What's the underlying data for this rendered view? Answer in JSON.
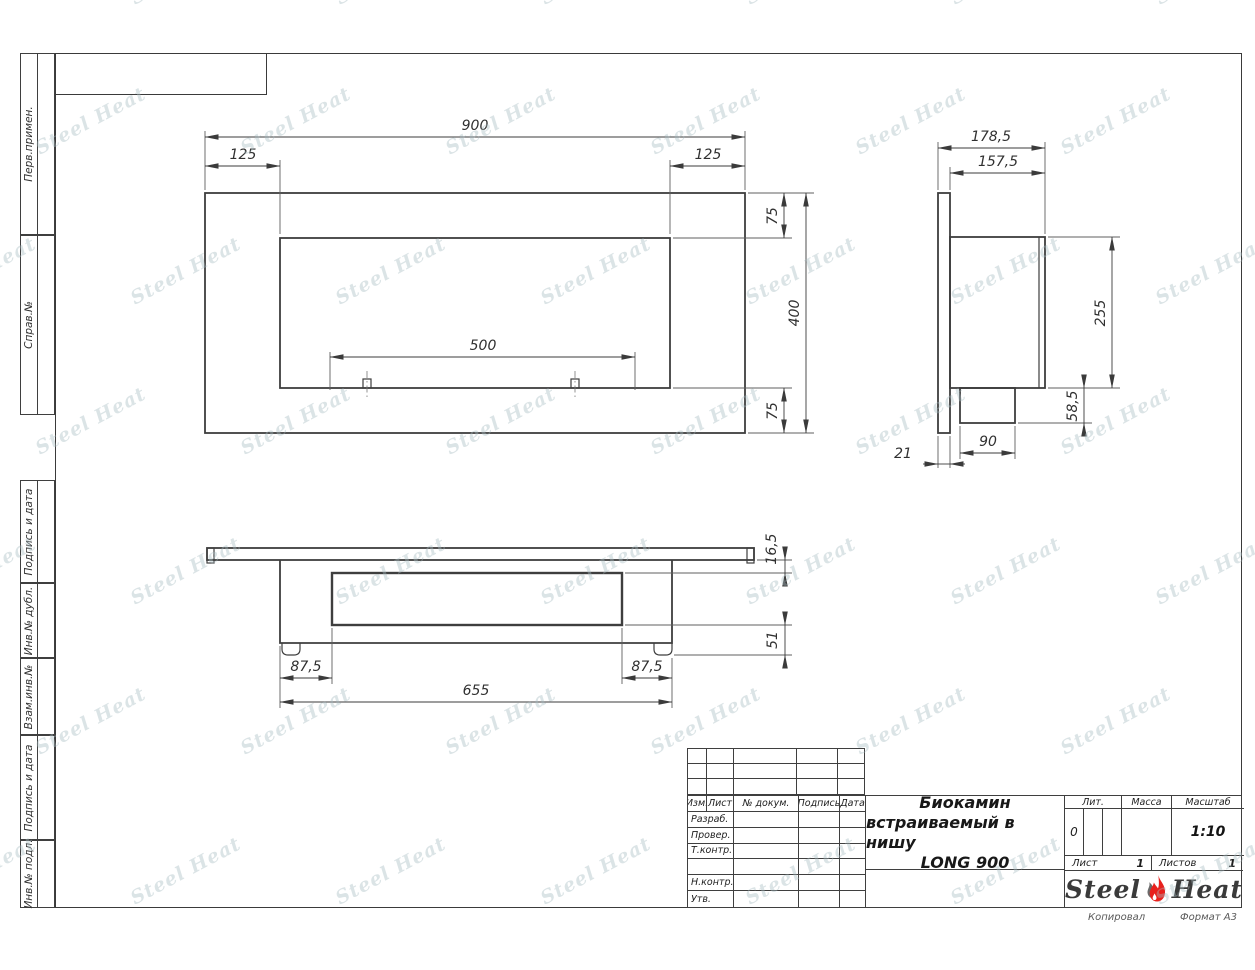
{
  "watermark": {
    "text": "Steel Heat"
  },
  "frame": {
    "left_labels": [
      {
        "label": "Перв.примен."
      },
      {
        "label": "Справ.№"
      },
      {
        "label": "Подпись и дата"
      },
      {
        "label": "Инв.№ дубл."
      },
      {
        "label": "Взам.инв.№"
      },
      {
        "label": "Подпись и дата"
      },
      {
        "label": "Инв.№ подл."
      }
    ]
  },
  "views": {
    "front": {
      "dims": {
        "width": "900",
        "left_offset": "125",
        "right_offset": "125",
        "top_offset": "75",
        "height": "400",
        "bottom_offset": "75",
        "burner": "500"
      }
    },
    "side": {
      "dims": {
        "depth_total": "178,5",
        "depth_body": "157,5",
        "body_height": "255",
        "ledge_height": "58,5",
        "ledge_depth": "90",
        "panel_thickness": "21"
      }
    },
    "bottom": {
      "dims": {
        "frame_depth": "16,5",
        "box_depth": "51",
        "side_left": "87,5",
        "side_right": "87,5",
        "body_width": "655"
      }
    }
  },
  "title_block": {
    "columns": [
      "Изм.",
      "Лист",
      "№ докум.",
      "Подпись",
      "Дата"
    ],
    "rows": [
      "Разраб.",
      "Провер.",
      "Т.контр.",
      "",
      "Н.контр.",
      "Утв."
    ],
    "title_line1": "Биокамин",
    "title_line2": "встраиваемый в нишу",
    "title_line3": "LONG 900",
    "lit_label": "Лит.",
    "lit_value": "0",
    "mass_label": "Масса",
    "scale_label": "Масштаб",
    "scale_value": "1:10",
    "sheet_label": "Лист",
    "sheet_value": "1",
    "sheets_label": "Листов",
    "sheets_value": "1",
    "logo_steel": "Steel",
    "logo_heat": "Heat",
    "footer_left": "Копировал",
    "footer_right": "Формат А3"
  }
}
